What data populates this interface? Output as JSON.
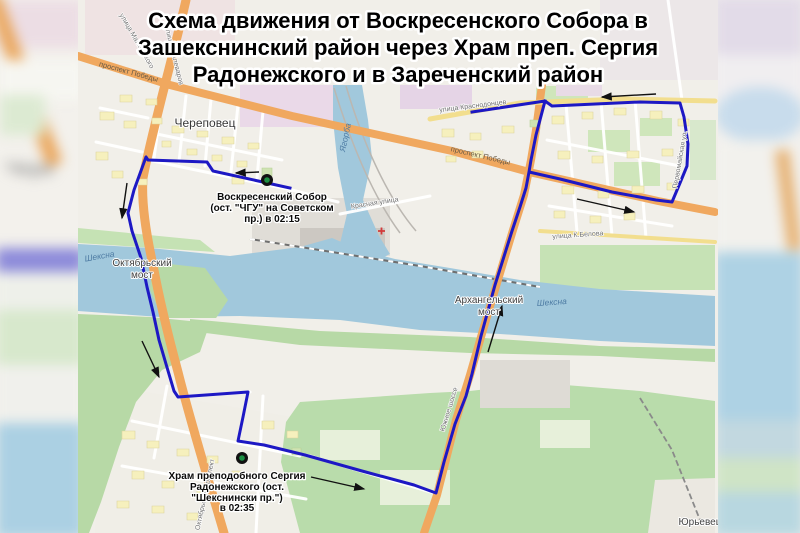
{
  "title": {
    "lines": [
      "Схема движения от Воскресенского Собора в",
      "Зашекснинский район через Храм преп. Сергия",
      "Радонежского и в Зареченский район"
    ]
  },
  "annotations": {
    "stop1": {
      "line1": "Воскресенский Собор",
      "line2": "(ост. \"ЧГУ\" на Советском",
      "line3": "пр.) в 02:15"
    },
    "stop2": {
      "line1": "Храм преподобного Сергия",
      "line2": "Радонежского (ост.",
      "line3": "\"Шекснински пр.\")",
      "line4": "в 02:35"
    }
  },
  "map_labels": {
    "city": "Череповец",
    "bridge_okt_1": "Октябрьский",
    "bridge_okt_2": "мост",
    "bridge_arh_1": "Архангельский",
    "bridge_arh_2": "мост",
    "river_sheksna_west": "Шексна",
    "river_sheksna_east": "Шексна",
    "river_yagorba": "Ягорба",
    "prospekt_pobedy_west": "проспект Победы",
    "prospekt_pobedy_east": "проспект Победы",
    "ulitsa_stalevarov": "улица Сталеваров",
    "ulitsa_mayakovskogo": "улица Маяковского",
    "ulitsa_krasnodontsev": "улица Краснодонцев",
    "krasnaya_ulitsa": "Красная улица",
    "ulitsa_belova": "улица К.Белова",
    "pervomayskaya": "Первомайская ул.",
    "yuzhnoe_shosse": "Южное шоссе",
    "oktyabrsky_prospekt": "Октябрьский проспект",
    "yurevets": "Юрьевец",
    "blur_city_fragment": "Чере"
  },
  "colors": {
    "route": "#1d18c4",
    "water": "#a1c8dc",
    "green": "#b7d9a6",
    "road_orange": "#f0a85f",
    "road_yellow": "#f2de8e",
    "marker_outer": "#111111",
    "marker_inner": "#1d8f43",
    "arrow": "#111111"
  }
}
